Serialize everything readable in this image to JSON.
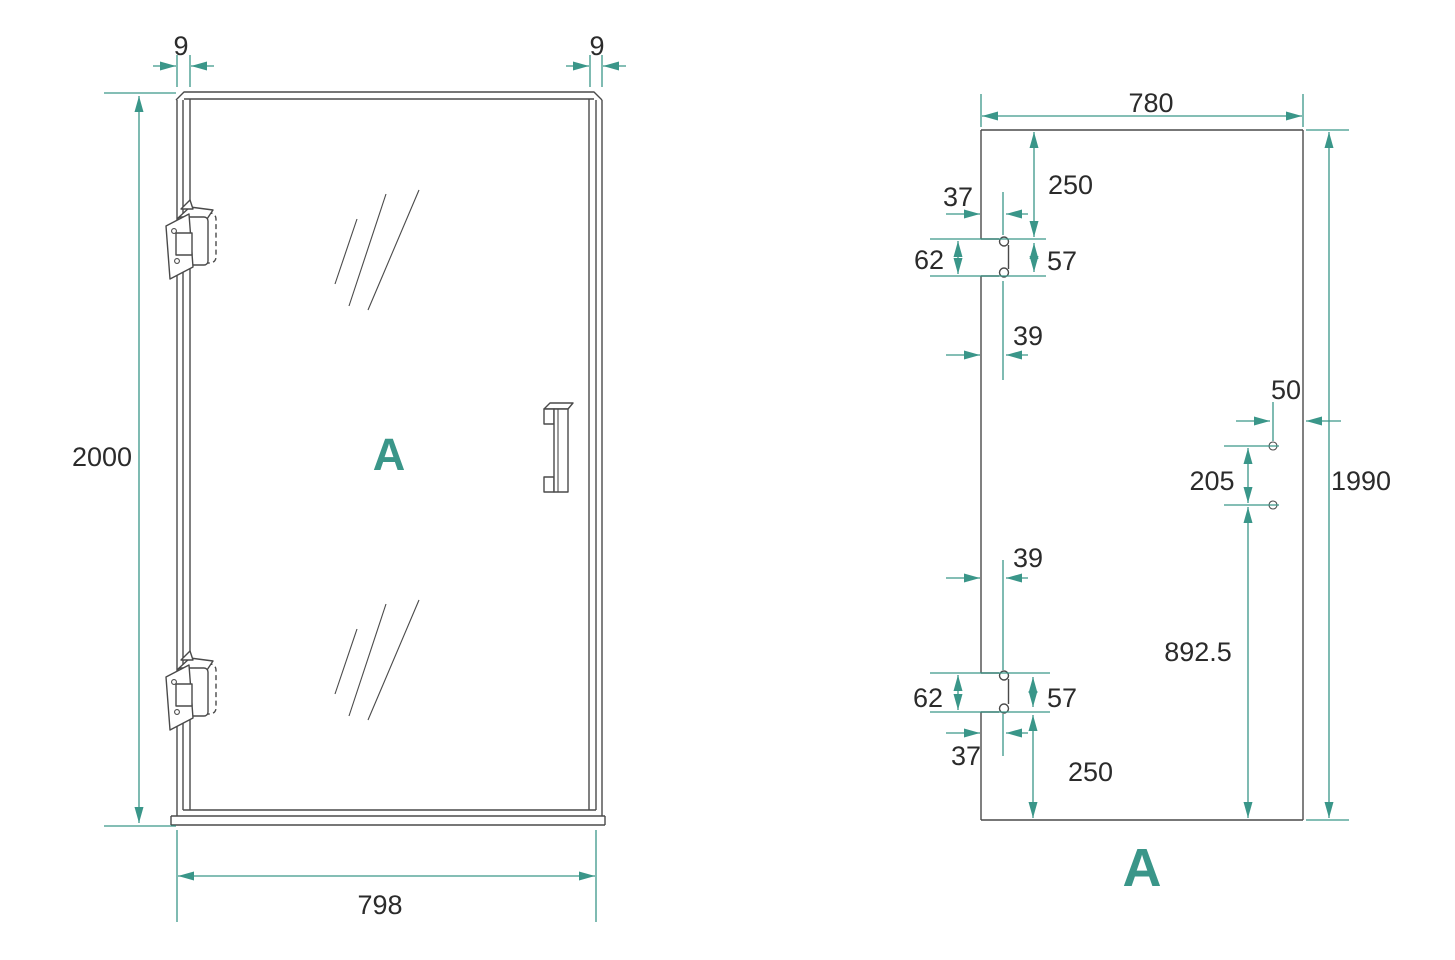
{
  "colors": {
    "accent": "#3a9689",
    "line": "#4a4a4a",
    "text": "#2b2b2b"
  },
  "front_view": {
    "label": "A",
    "dims": {
      "frame_left": "9",
      "frame_right": "9",
      "height": "2000",
      "width": "798"
    }
  },
  "glass_view": {
    "label": "A",
    "dims": {
      "width": "780",
      "height": "1990",
      "top_offset": "250",
      "top_edge_dist": "37",
      "top_cut_height": "62",
      "top_hole_pitch": "57",
      "top_hole_inset": "39",
      "handle_edge_dist": "50",
      "handle_hole_pitch": "205",
      "handle_bottom_dist": "892.5",
      "bottom_hole_inset": "39",
      "bottom_cut_height": "62",
      "bottom_hole_pitch": "57",
      "bottom_edge_dist": "37",
      "bottom_offset": "250"
    }
  }
}
